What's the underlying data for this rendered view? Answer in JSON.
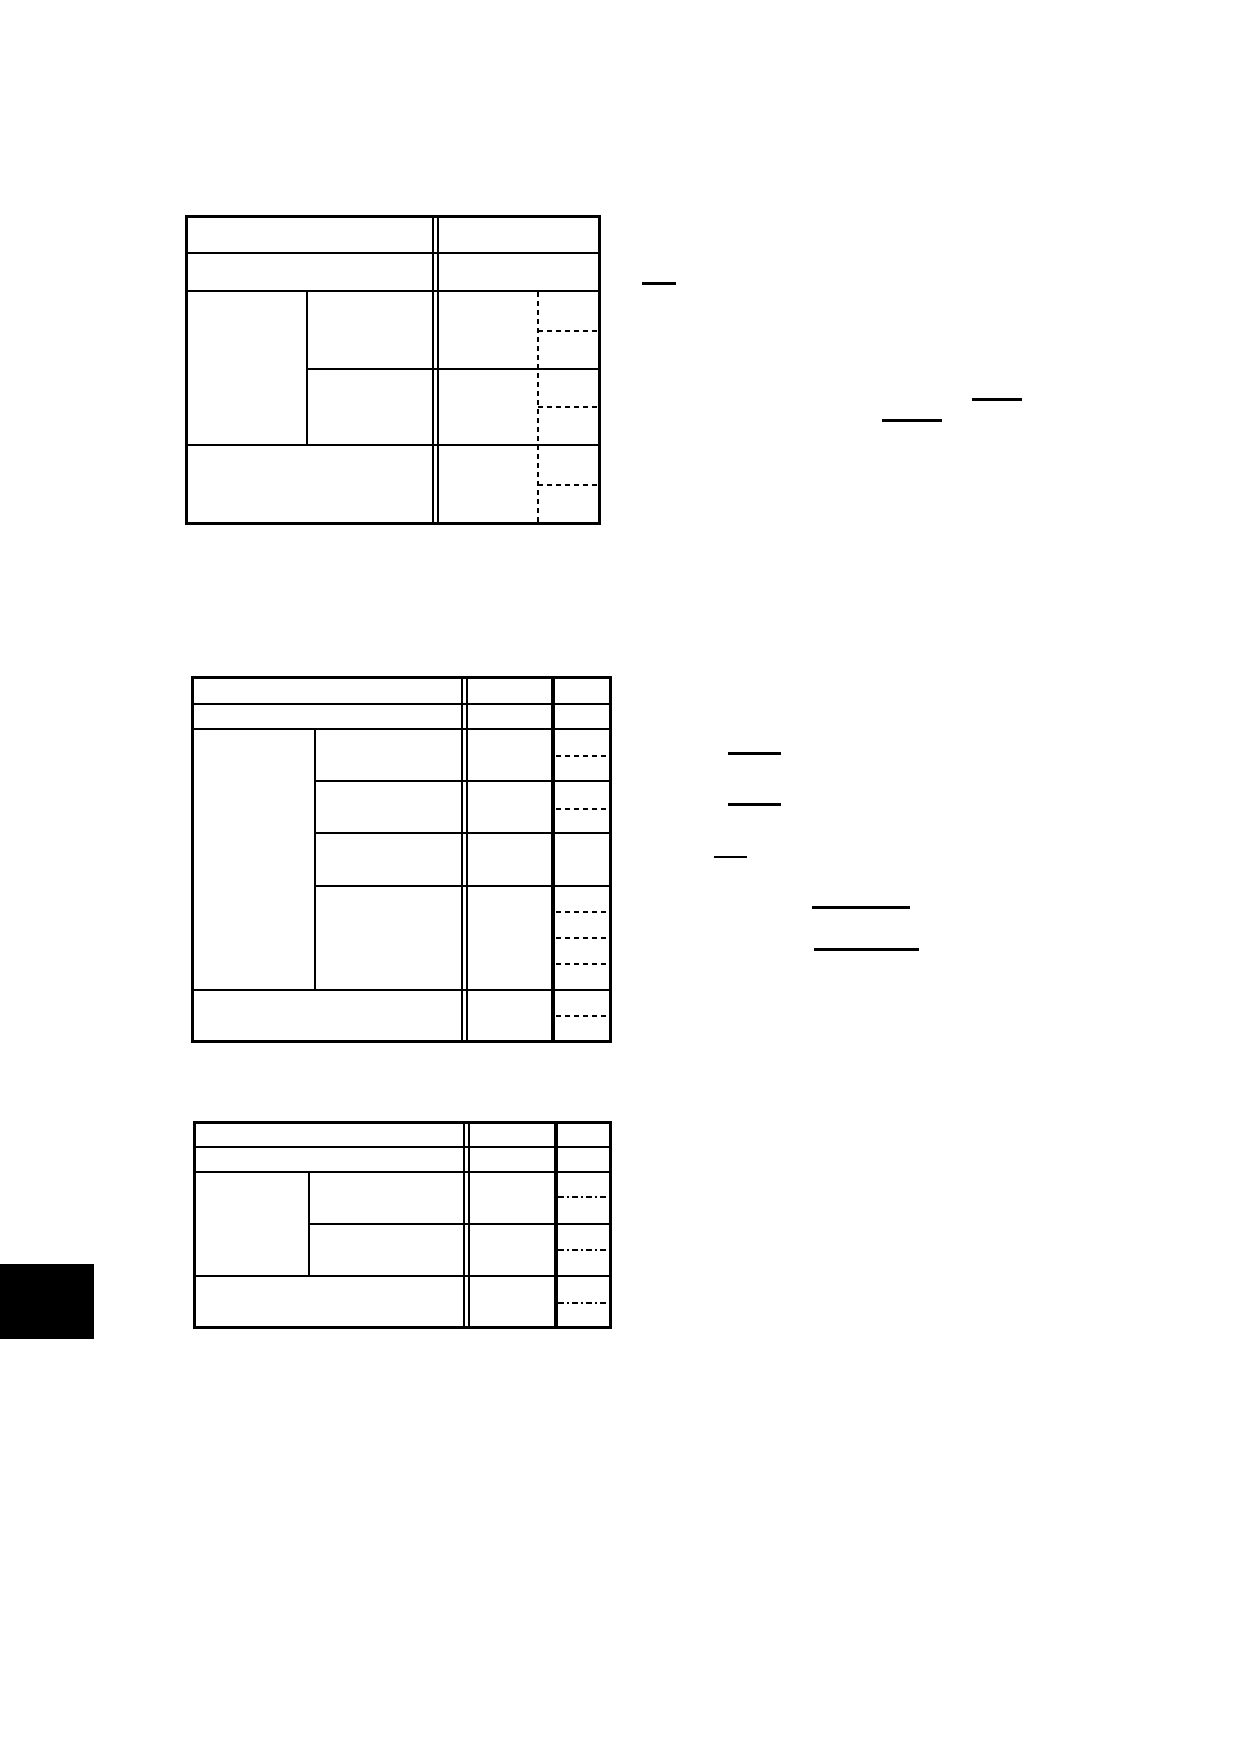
{
  "page": {
    "background_color": "#ffffff",
    "ink_color": "#000000"
  },
  "tables": {
    "count": 3,
    "text_content": ""
  },
  "margin_rules": {
    "count": 8,
    "color": "#000000"
  },
  "registration_block": {
    "color": "#000000"
  }
}
